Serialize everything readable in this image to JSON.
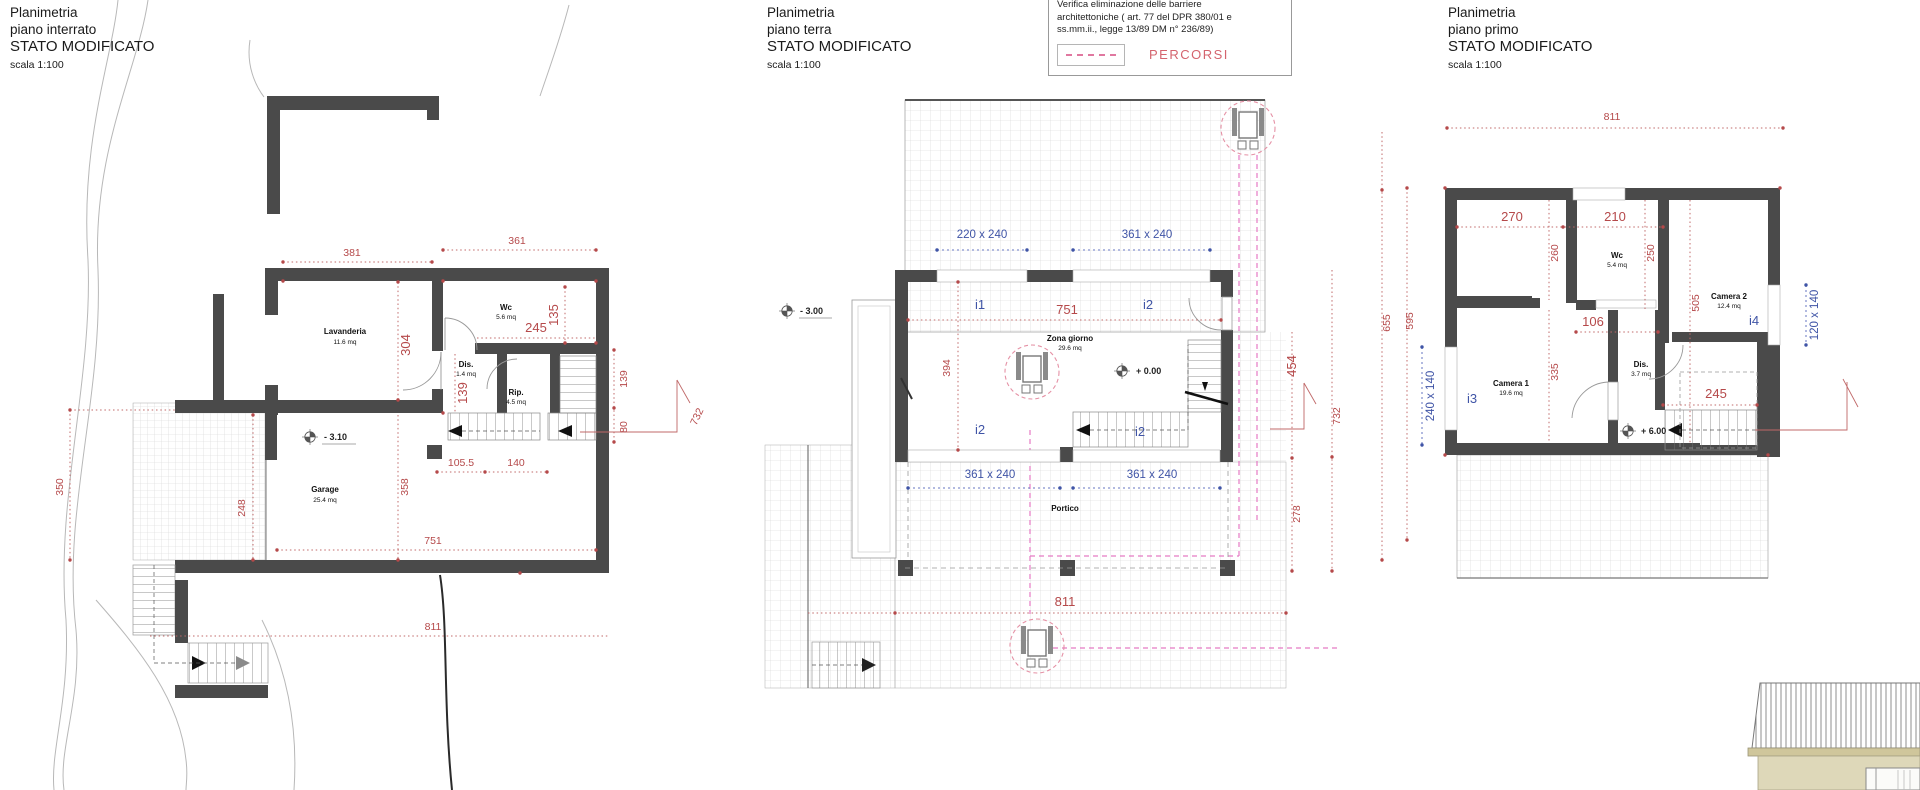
{
  "titles": {
    "basement": {
      "l1": "Planimetria",
      "l2": "piano interrato",
      "l3": "STATO MODIFICATO",
      "l4": "scala 1:100"
    },
    "ground": {
      "l1": "Planimetria",
      "l2": "piano terra",
      "l3": "STATO MODIFICATO",
      "l4": "scala 1:100"
    },
    "first": {
      "l1": "Planimetria",
      "l2": "piano primo",
      "l3": "STATO MODIFICATO",
      "l4": "scala 1:100"
    }
  },
  "legend": {
    "line1": "Verifica eliminazione delle barriere",
    "line2": "architettoniche ( art. 77 del DPR 380/01 e",
    "line3": "ss.mm.ii., legge 13/89 DM n° 236/89)",
    "swatch_label": "PERCORSI"
  },
  "colors": {
    "dimension_red": "#b5494a",
    "label_blue": "#3f54a6",
    "wall_gray": "#4a4a4a",
    "percorsi_pink": "#e57ac4",
    "percorsi_label": "#d4646e",
    "elevation_beige": "#ded8b9"
  },
  "basement": {
    "level": "- 3.10",
    "rooms": {
      "lavanderia": {
        "name": "Lavanderia",
        "area": "11.6 mq"
      },
      "wc": {
        "name": "Wc",
        "area": "5.6 mq"
      },
      "dis": {
        "name": "Dis.",
        "area": "1.4 mq"
      },
      "rip": {
        "name": "Rip.",
        "area": "4.5 mq"
      },
      "garage": {
        "name": "Garage",
        "area": "25.4 mq"
      }
    },
    "dims": {
      "d381": "381",
      "d361": "361",
      "d245": "245",
      "d135": "135",
      "d304": "304",
      "d139i": "139",
      "d139": "139",
      "d80": "80",
      "d732": "732",
      "d350": "350",
      "d248": "248",
      "d358": "358",
      "d105": "105.5",
      "d140": "140",
      "d751": "751",
      "d811": "811"
    }
  },
  "ground": {
    "level_out": "- 3.00",
    "level_in": "+ 0.00",
    "zona_name": "Zona giorno",
    "zona_area": "29.6 mq",
    "portico": "Portico",
    "win_220": "220 x 240",
    "win_361a": "361 x 240",
    "win_361b": "361 x 240",
    "win_361c": "361 x 240",
    "i1": "i1",
    "i2a": "i2",
    "i2b": "i2",
    "i2c": "i2",
    "dims": {
      "d751": "751",
      "d394": "394",
      "d454": "454",
      "d732": "732",
      "d278": "278",
      "d811": "811"
    }
  },
  "first": {
    "level": "+ 6.00",
    "rooms": {
      "wc": {
        "name": "Wc",
        "area": "5.4 mq"
      },
      "camera2": {
        "name": "Camera 2",
        "area": "12.4 mq"
      },
      "camera1": {
        "name": "Camera 1",
        "area": "19.6 mq"
      },
      "dis": {
        "name": "Dis.",
        "area": "3.7 mq"
      }
    },
    "win_left": "240 x 140",
    "win_right": "120 x 140",
    "i3": "i3",
    "i4": "i4",
    "dims": {
      "d811": "811",
      "d270": "270",
      "d210": "210",
      "d260": "260",
      "d250": "250",
      "d106": "106",
      "d505": "505",
      "d655": "655",
      "d595": "595",
      "d335": "335",
      "d245": "245"
    }
  }
}
